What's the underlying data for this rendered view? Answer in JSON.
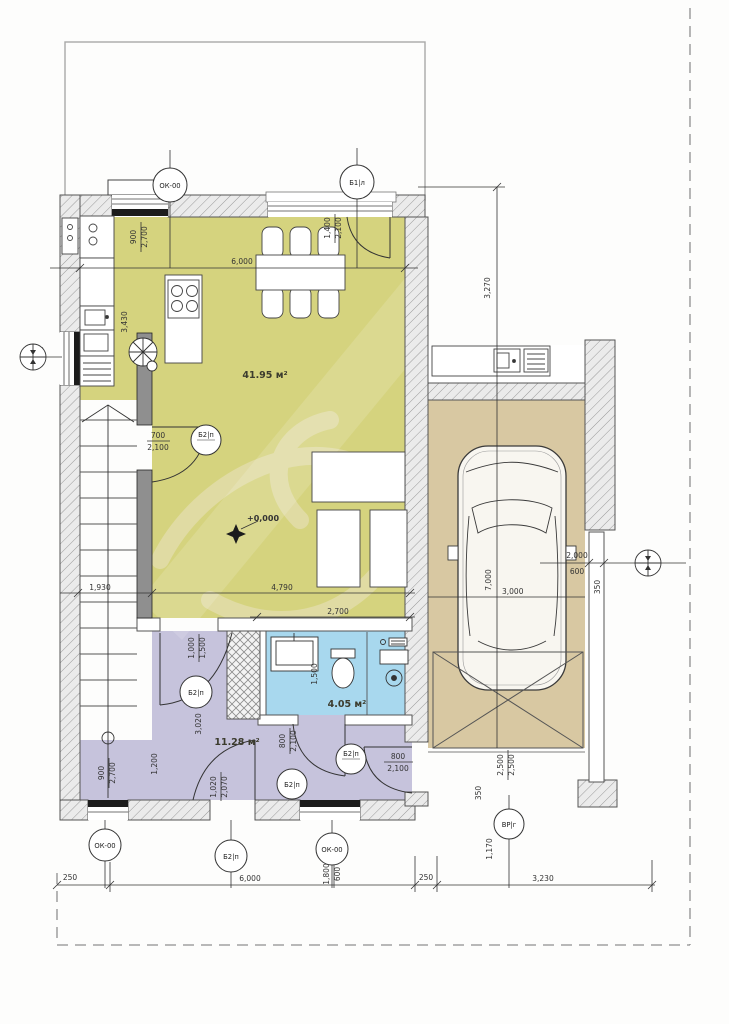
{
  "plan": {
    "rooms": {
      "living": {
        "area": "41.95 м²"
      },
      "hall": {
        "area": "11.28 м²"
      },
      "bath": {
        "area": "4.05 м²"
      }
    },
    "level_mark": "+0,000",
    "tags": {
      "window": "ОК-00",
      "balcony_door": "Б1|л",
      "door": "Б2|п",
      "gate": "ВР|г"
    },
    "dims": {
      "top_width": "6,000",
      "garage_offset": "3,270",
      "win_tl_w": "900",
      "win_tl_h": "2,700",
      "kitchen_left": "3,430",
      "stair_door_w": "700",
      "stair_door_h": "2,100",
      "living_w": "4,790",
      "stair_run": "1,930",
      "bath_w": "2,700",
      "balcony_w": "1,400",
      "balcony_h": "2,100",
      "left_win_w": "900",
      "left_win_h": "600",
      "right_win_w": "2,000",
      "right_win_h": "600",
      "garage_w": "3,000",
      "garage_l": "7,000",
      "bath_d": "1,500",
      "ward_a": "1,000",
      "ward_b": "1,500",
      "hall_len": "3,020",
      "bath_door_w": "800",
      "bath_door_h": "2,100",
      "hall_side": "1,200",
      "win_bl_w": "900",
      "win_bl_h": "2,700",
      "entry_w": "1,020",
      "entry_h": "2,070",
      "gdoor_w": "800",
      "gdoor_h": "2,100",
      "gate_w": "2,500",
      "gate_h": "2,500",
      "wall_a": "350",
      "wall_b": "350",
      "gate_off": "1,170",
      "b_off_l": "250",
      "b_width": "6,000",
      "b_off_m": "250",
      "b_right": "3,230",
      "win_b_w": "1,800",
      "win_b_h": "600"
    }
  }
}
